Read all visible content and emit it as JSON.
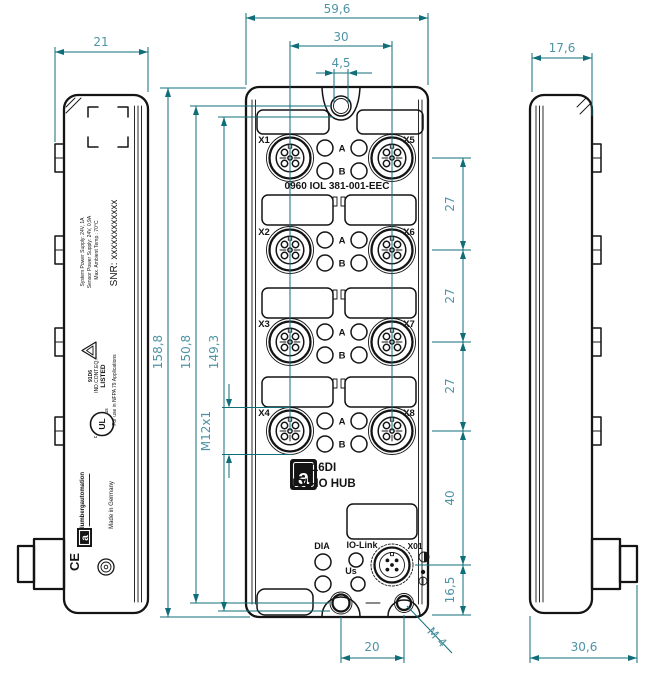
{
  "colors": {
    "dimension_line": "#0f6e78",
    "dimension_text": "#4f94a6",
    "drawing_line": "#141414"
  },
  "dims": {
    "front_width": "59,6",
    "connector_pitch": "30",
    "tab_hole": "4,5",
    "left_view_depth": "21",
    "right_view_body_depth": "17,6",
    "total_height": "158,8",
    "mount_hole_spacing": "150,8",
    "housing_height": "149,3",
    "row_gap1": "27",
    "row_gap2": "27",
    "row_gap3": "27",
    "x01_gap": "40",
    "x01_to_bottom": "16,5",
    "bottom_hole_pitch": "20",
    "bottom_thread": "M 4",
    "port_thread": "M12x1",
    "right_view_total_depth": "30,6"
  },
  "front_view": {
    "part_number": "0960 IOL 381-001-EEC",
    "ports": [
      {
        "left": "X1",
        "right": "X5"
      },
      {
        "left": "X2",
        "right": "X6"
      },
      {
        "left": "X3",
        "right": "X7"
      },
      {
        "left": "X4",
        "right": "X8"
      }
    ],
    "led_a": "A",
    "led_b": "B",
    "logo_letter": "a",
    "product_line1": "16DI",
    "product_line2": "IOL-IO HUB",
    "dia_label": "DIA",
    "iolink_label": "IO-Link",
    "us_label": "Us",
    "x01_label": "X01"
  },
  "left_view": {
    "spec_line1": "System Power Supply: 24V, 1A",
    "spec_line2": "Sensor Power Supply: 24V, 0,9A",
    "spec_line3": "Max. Ambient Temp.: 70°C",
    "snr": "SNR: xxxxxxxxxxxx",
    "ul_line1": "LISTED",
    "ul_line2": "IND.CONT.EQ.",
    "ul_line3": "91D6",
    "ul_mark": "UL",
    "ul_c": "c",
    "ul_us": "us",
    "nfpa": "For use in NFPA 79 Applications",
    "brand": "lumbergautomation",
    "logo_letter": "a",
    "made_in": "Made in Germany",
    "ce_mark": "CE"
  }
}
